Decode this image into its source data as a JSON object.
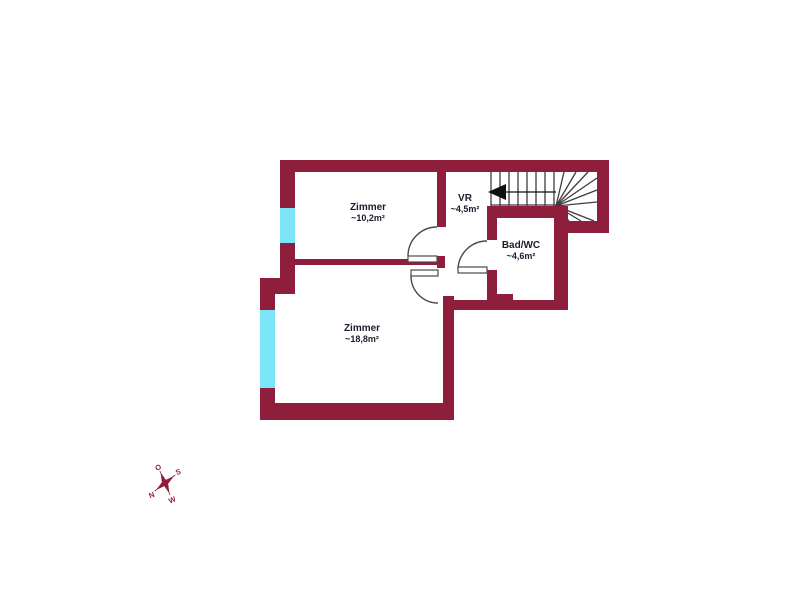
{
  "floorplan": {
    "title": "floor-plan",
    "rooms": [
      {
        "id": "zimmer-upper",
        "name": "Zimmer",
        "area": "~10,2m²"
      },
      {
        "id": "vr",
        "name": "VR",
        "area": "~4,5m²"
      },
      {
        "id": "bad-wc",
        "name": "Bad/WC",
        "area": "~4,6m²"
      },
      {
        "id": "zimmer-lower",
        "name": "Zimmer",
        "area": "~18,8m²"
      }
    ],
    "compass": {
      "north": "N",
      "east": "O",
      "south": "S",
      "west": "W"
    },
    "colors": {
      "wall": "#8e1e3c",
      "window": "#7ce4f8",
      "line": "#3d3d3d",
      "door": "#4a4a4a",
      "text": "#1c1c2e",
      "arrow": "#101010"
    }
  }
}
